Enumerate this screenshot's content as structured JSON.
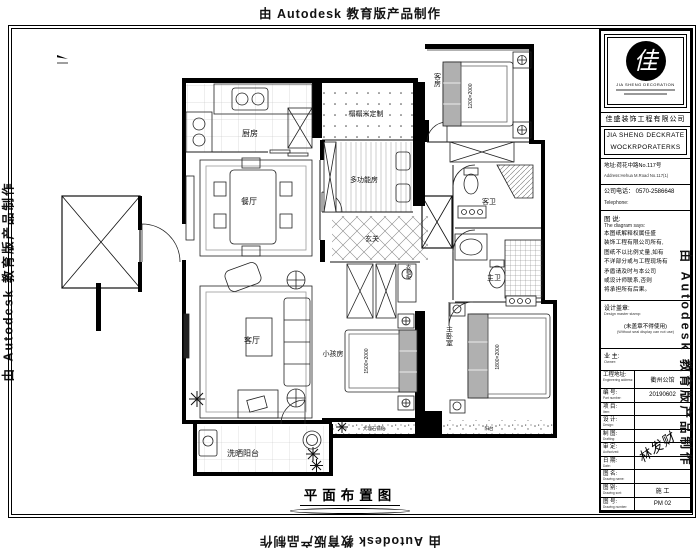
{
  "watermarks": {
    "top": "由 Autodesk 教育版产品制作",
    "bottom": "由 Autodesk 教育版产品制作",
    "left": "由 Autodesk 教育版产品制作",
    "right": "由 Autodesk 教育版产品制作"
  },
  "plan": {
    "caption": "平面布置图",
    "labels": {
      "kitchen": "厨房",
      "dining": "餐厅",
      "living": "客厅",
      "tatami": "榻榻米定制",
      "multi": "多功能房",
      "guest_room": "客房",
      "guest_bath": "客卫",
      "master_bath": "主卫",
      "entry": "玄关",
      "closet": "衣帽柜",
      "kids_room": "小孩房",
      "master_bedroom": "主卧室",
      "laundry": "洗晒阳台",
      "balcony_finish": "大理石铺贴",
      "balcony": "阳台"
    },
    "beds": {
      "guest": "1200×2000",
      "kids": "1500×2000",
      "master": "1800×2000"
    }
  },
  "titleblock": {
    "seal_glyph": "佳",
    "logo_sub": "JIA SHENG DECORATION",
    "company_cn": "佳盛装饰工程有限公司",
    "company_en_1": "JIA SHENG DECKRATE",
    "company_en_2": "WOCKRPORATERKS",
    "address_cn": "地址:荷花中路No.117号",
    "address_en": "Address:Hehua M.Road No.117(1)",
    "phone_cn": "公司电话：  0570-2586648",
    "phone_en": "Telephone:",
    "diagram_label_cn": "图 说:",
    "diagram_label_en": "The diagram says:",
    "notes": [
      "本图纸解释权属佳盛",
      "装饰工程有限公司所有,",
      "图纸不以比例丈量,如有",
      "不详部分或与工程现场有",
      "矛盾请及时与本公司",
      "或设计师联系,否则",
      "将承担所有后果。"
    ],
    "seal_label_cn": "设计盖章:",
    "seal_label_en": "Design master stamp:",
    "seal_note_cn": "(未盖章不得使用)",
    "seal_note_en": "(Without seal display can not use)",
    "rows": [
      {
        "cn": "工程地址:",
        "en": "Engineering address:",
        "value": "衢州公馆"
      },
      {
        "cn": "编 号:",
        "en": "Part number:",
        "value": "20190602"
      },
      {
        "cn": "项 目:",
        "en": "Item:",
        "value": ""
      },
      {
        "cn": "设 计:",
        "en": "Design:",
        "value": ""
      },
      {
        "cn": "制 图:",
        "en": "Drafting:",
        "value": ""
      },
      {
        "cn": "审 定:",
        "en": "Authorized:",
        "value": ""
      },
      {
        "cn": "日 期:",
        "en": "Date:",
        "value": ""
      },
      {
        "cn": "图 名:",
        "en": "Drawing name:",
        "value": ""
      },
      {
        "cn": "图 别:",
        "en": "Drawing sort:",
        "value": "施 工"
      },
      {
        "cn": "图 号:",
        "en": "Drawing number:",
        "value": "PM 02"
      }
    ],
    "signature": "林发财"
  }
}
